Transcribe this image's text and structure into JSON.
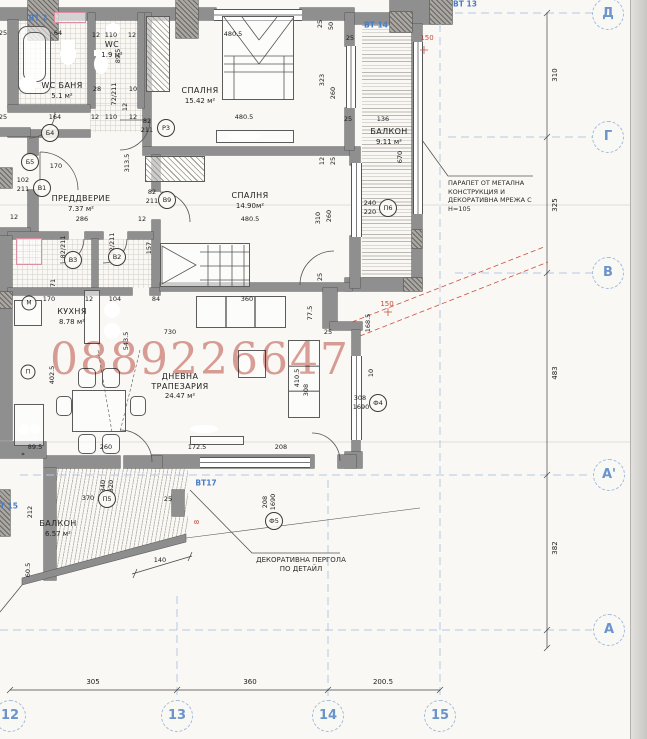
{
  "watermark": {
    "text": "0889226647",
    "color": "#c25b4e"
  },
  "rooms": [
    {
      "lines": [
        "СПАЛНЯ"
      ],
      "area": "15.42 м²",
      "x": 200,
      "y": 95
    },
    {
      "lines": [
        "СПАЛНЯ"
      ],
      "area": "14.90м²",
      "x": 250,
      "y": 200
    },
    {
      "lines": [
        "ПРЕДДВЕРИЕ"
      ],
      "area": "7.37 м²",
      "x": 81,
      "y": 203
    },
    {
      "lines": [
        "КУХНЯ"
      ],
      "area": "8.78 м²",
      "x": 72,
      "y": 316
    },
    {
      "lines": [
        "ДНЕВНА",
        "ТРАПЕЗАРИЯ"
      ],
      "area": "24.47 м²",
      "x": 180,
      "y": 386
    },
    {
      "lines": [
        "БАЛКОН"
      ],
      "area": "9.11 м²",
      "x": 389,
      "y": 136
    },
    {
      "lines": [
        "БАЛКОН"
      ],
      "area": "6.57 м²",
      "x": 58,
      "y": 528
    },
    {
      "lines": [
        "WC БАНЯ"
      ],
      "area": "5.1 м²",
      "x": 62,
      "y": 90
    },
    {
      "lines": [
        "WC"
      ],
      "area": "1.9 м²",
      "x": 112,
      "y": 49
    }
  ],
  "grid": {
    "row_bubbles": [
      [
        "Д",
        608,
        14
      ],
      [
        "Г",
        608,
        137
      ],
      [
        "В",
        608,
        273
      ],
      [
        "А'",
        609,
        475
      ],
      [
        "А",
        609,
        630
      ]
    ],
    "col_bubbles": [
      [
        "12",
        10,
        716
      ],
      [
        "13",
        177,
        716
      ],
      [
        "14",
        328,
        716
      ],
      [
        "15",
        440,
        716
      ]
    ],
    "right_dims": [
      [
        "310",
        555,
        75
      ],
      [
        "325",
        555,
        205
      ],
      [
        "483",
        555,
        373
      ],
      [
        "382",
        555,
        548
      ]
    ],
    "bottom_dims": [
      [
        "305",
        93,
        682
      ],
      [
        "360",
        250,
        682
      ],
      [
        "200.5",
        383,
        682
      ]
    ]
  },
  "annotations": {
    "parapet": {
      "lines": [
        "ПАРАПЕТ ОТ МЕТАЛНА",
        "КОНСТРУКЦИЯ И",
        "ДЕКОРАТИВНА МРЕЖА С",
        "Н=105"
      ]
    },
    "pergola": {
      "lines": [
        "ДЕКОРАТИВНА ПЕРГОЛА",
        "ПО ДЕТАЙЛ"
      ]
    }
  },
  "blue_markers": [
    [
      "ВТ 2",
      38,
      18
    ],
    [
      "ВТ 13",
      465,
      4
    ],
    [
      "ВТ 14",
      376,
      25
    ],
    [
      "ВТ17",
      206,
      483
    ],
    [
      "ВТ 15",
      6,
      506
    ]
  ],
  "red_markers": [
    [
      "150",
      427,
      38,
      0
    ],
    [
      "150",
      387,
      304,
      0
    ],
    [
      "8",
      197,
      522,
      1
    ]
  ],
  "door_window_tags": [
    [
      "В1",
      42,
      188,
      0
    ],
    [
      "Р3",
      166,
      128,
      0
    ],
    [
      "Б4",
      50,
      133,
      0
    ],
    [
      "Б5",
      30,
      162,
      0
    ],
    [
      "В3",
      73,
      260,
      0
    ],
    [
      "В2",
      117,
      257,
      0
    ],
    [
      "В9",
      167,
      200,
      0
    ],
    [
      "П6",
      388,
      208,
      0
    ],
    [
      "П5",
      107,
      499,
      0
    ],
    [
      "Ф4",
      378,
      403,
      0
    ],
    [
      "Ф5",
      274,
      521,
      0
    ],
    [
      "М",
      29,
      303,
      1
    ],
    [
      "П",
      28,
      372,
      1
    ]
  ],
  "dims": [
    [
      "64",
      58,
      33,
      0
    ],
    [
      "12",
      96,
      35,
      0
    ],
    [
      "110",
      111,
      35,
      0
    ],
    [
      "12",
      132,
      35,
      0
    ],
    [
      "480.5",
      233,
      34,
      0
    ],
    [
      "25",
      320,
      24,
      1
    ],
    [
      "50",
      331,
      26,
      1
    ],
    [
      "25",
      350,
      38,
      0
    ],
    [
      "25",
      3,
      33,
      0
    ],
    [
      "25",
      3,
      117,
      0
    ],
    [
      "164",
      55,
      117,
      0
    ],
    [
      "12",
      95,
      117,
      0
    ],
    [
      "110",
      111,
      117,
      0
    ],
    [
      "12",
      133,
      117,
      0
    ],
    [
      "28",
      97,
      89,
      0
    ],
    [
      "10",
      133,
      89,
      0
    ],
    [
      "12",
      125,
      107,
      1
    ],
    [
      "89.5",
      118,
      56,
      1
    ],
    [
      "72/211",
      114,
      94,
      1
    ],
    [
      "323",
      322,
      80,
      1
    ],
    [
      "260",
      333,
      93,
      1
    ],
    [
      "480.5",
      244,
      117,
      0
    ],
    [
      "82",
      147,
      121,
      0
    ],
    [
      "211",
      147,
      130,
      0
    ],
    [
      "102",
      23,
      180,
      0
    ],
    [
      "211",
      23,
      189,
      0
    ],
    [
      "313.5",
      127,
      163,
      1
    ],
    [
      "170",
      56,
      166,
      0
    ],
    [
      "286",
      82,
      219,
      0
    ],
    [
      "12",
      14,
      217,
      0
    ],
    [
      "12",
      142,
      219,
      0
    ],
    [
      "82",
      152,
      192,
      0
    ],
    [
      "211",
      152,
      201,
      0
    ],
    [
      "157",
      149,
      248,
      1
    ],
    [
      "82/211",
      63,
      247,
      1
    ],
    [
      "82/211",
      112,
      244,
      1
    ],
    [
      "480.5",
      250,
      219,
      0
    ],
    [
      "310",
      318,
      218,
      1
    ],
    [
      "260",
      329,
      216,
      1
    ],
    [
      "12",
      322,
      161,
      1
    ],
    [
      "25",
      333,
      161,
      1
    ],
    [
      "25",
      320,
      277,
      1
    ],
    [
      "136",
      383,
      119,
      0
    ],
    [
      "670",
      400,
      157,
      1
    ],
    [
      "240",
      370,
      203,
      0
    ],
    [
      "220",
      370,
      212,
      0
    ],
    [
      "25",
      348,
      119,
      0
    ],
    [
      "170",
      49,
      299,
      0
    ],
    [
      "12",
      89,
      299,
      0
    ],
    [
      "104",
      115,
      299,
      0
    ],
    [
      "84",
      156,
      299,
      0
    ],
    [
      "730",
      170,
      332,
      0
    ],
    [
      "543.5",
      126,
      341,
      1
    ],
    [
      "402.5",
      52,
      375,
      1
    ],
    [
      "360",
      247,
      299,
      0
    ],
    [
      "77.5",
      310,
      313,
      1
    ],
    [
      "25",
      328,
      332,
      0
    ],
    [
      "410.5",
      297,
      378,
      1
    ],
    [
      "308",
      306,
      390,
      1
    ],
    [
      "168.5",
      368,
      323,
      1
    ],
    [
      "10",
      371,
      373,
      1
    ],
    [
      "308",
      360,
      398,
      0
    ],
    [
      "1690",
      361,
      407,
      0
    ],
    [
      "89.5",
      35,
      447,
      0
    ],
    [
      "*",
      23,
      455,
      0
    ],
    [
      "260",
      106,
      447,
      0
    ],
    [
      "172.5",
      197,
      447,
      0
    ],
    [
      "208",
      281,
      447,
      0
    ],
    [
      "370",
      88,
      498,
      0
    ],
    [
      "212",
      30,
      512,
      1
    ],
    [
      "340",
      103,
      486,
      1
    ],
    [
      "320",
      111,
      486,
      1
    ],
    [
      "25",
      168,
      499,
      0
    ],
    [
      "140",
      160,
      560,
      0
    ],
    [
      "60.5",
      28,
      570,
      1
    ],
    [
      "208",
      265,
      502,
      1
    ],
    [
      "1690",
      273,
      502,
      1
    ],
    [
      "71",
      53,
      283,
      1
    ]
  ]
}
